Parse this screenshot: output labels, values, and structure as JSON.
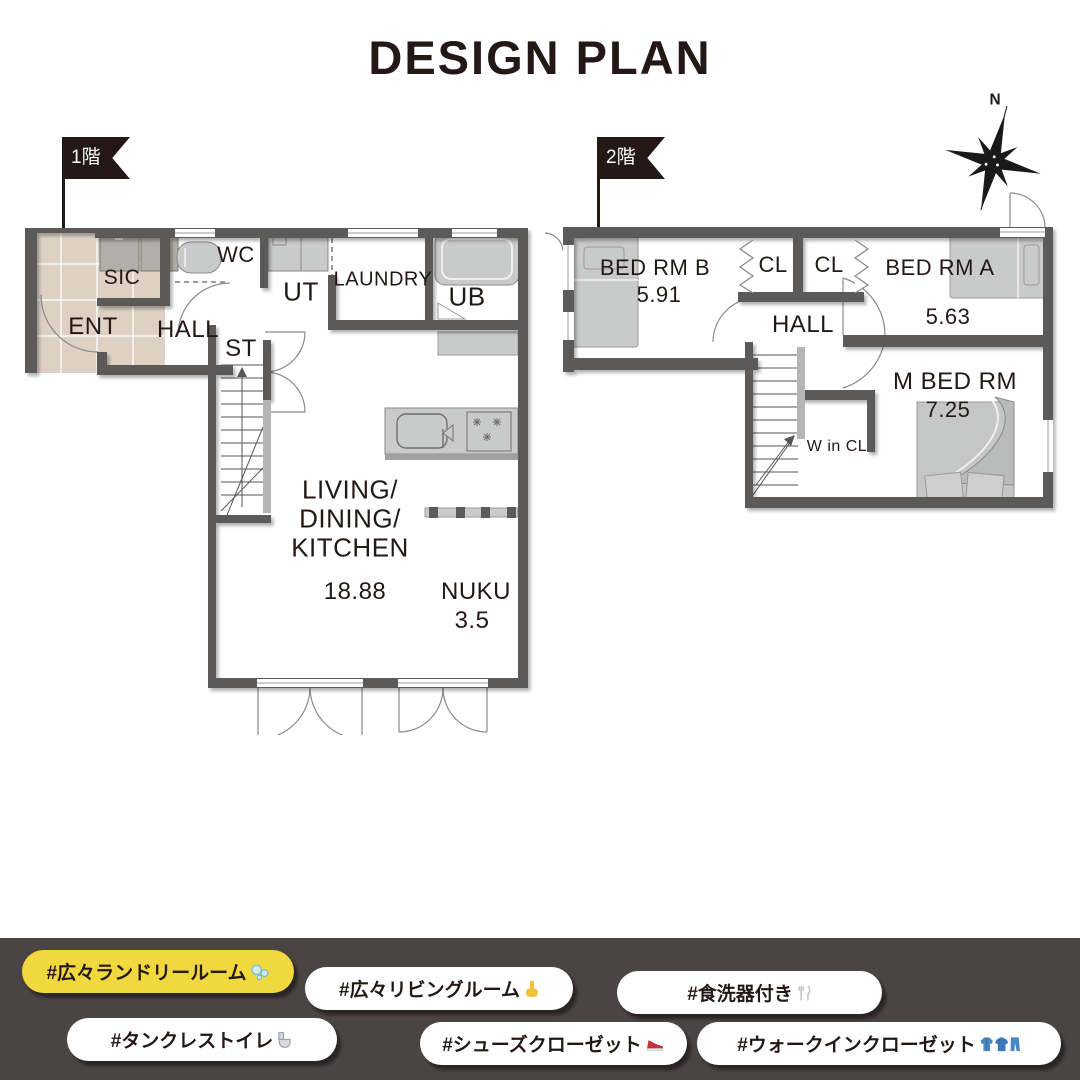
{
  "title": "DESIGN PLAN",
  "flags": {
    "floor1": "1階",
    "floor2": "2階"
  },
  "compass": {
    "north": "N"
  },
  "plan1": {
    "name": "1st floor plan",
    "rooms": {
      "ent": "ENT",
      "sic": "SIC",
      "wc": "WC",
      "ut": "UT",
      "laundry": "LAUNDRY",
      "ub": "UB",
      "hall": "HALL",
      "st": "ST",
      "ldk1": "LIVING/",
      "ldk2": "DINING/",
      "ldk3": "KITCHEN",
      "ldk_area": "18.88",
      "nuku": "NUKU",
      "nuku_area": "3.5"
    }
  },
  "plan2": {
    "name": "2nd floor plan",
    "rooms": {
      "bed_b": "BED RM B",
      "bed_b_area": "5.91",
      "cl1": "CL",
      "cl2": "CL",
      "bed_a": "BED RM A",
      "bed_a_area": "5.63",
      "hall": "HALL",
      "w_in_cl": "W in CL",
      "m_bed": "M BED RM",
      "m_bed_area": "7.25"
    }
  },
  "hashtags": [
    {
      "label": "#広々ランドリールーム",
      "icon": "bubbles-emoji",
      "variant": "yellow"
    },
    {
      "label": "#広々リビングルーム",
      "icon": "pointing-up-emoji",
      "variant": "white"
    },
    {
      "label": "#食洗器付き",
      "icon": "fork-knife-plate-emoji",
      "variant": "white"
    },
    {
      "label": "#タンクレストイレ",
      "icon": "toilet-emoji",
      "variant": "white"
    },
    {
      "label": "#シューズクローゼット",
      "icon": "sneaker-emoji",
      "variant": "white"
    },
    {
      "label": "#ウォークインクローゼット",
      "icon": "clothes-emoji",
      "variant": "white"
    }
  ],
  "colors": {
    "accent_yellow": "#f1d83e",
    "wall": "#5b5a59",
    "fixture": "#c9caca",
    "tile": "#ddd1c3",
    "band": "#4a4442",
    "text": "#231815"
  }
}
